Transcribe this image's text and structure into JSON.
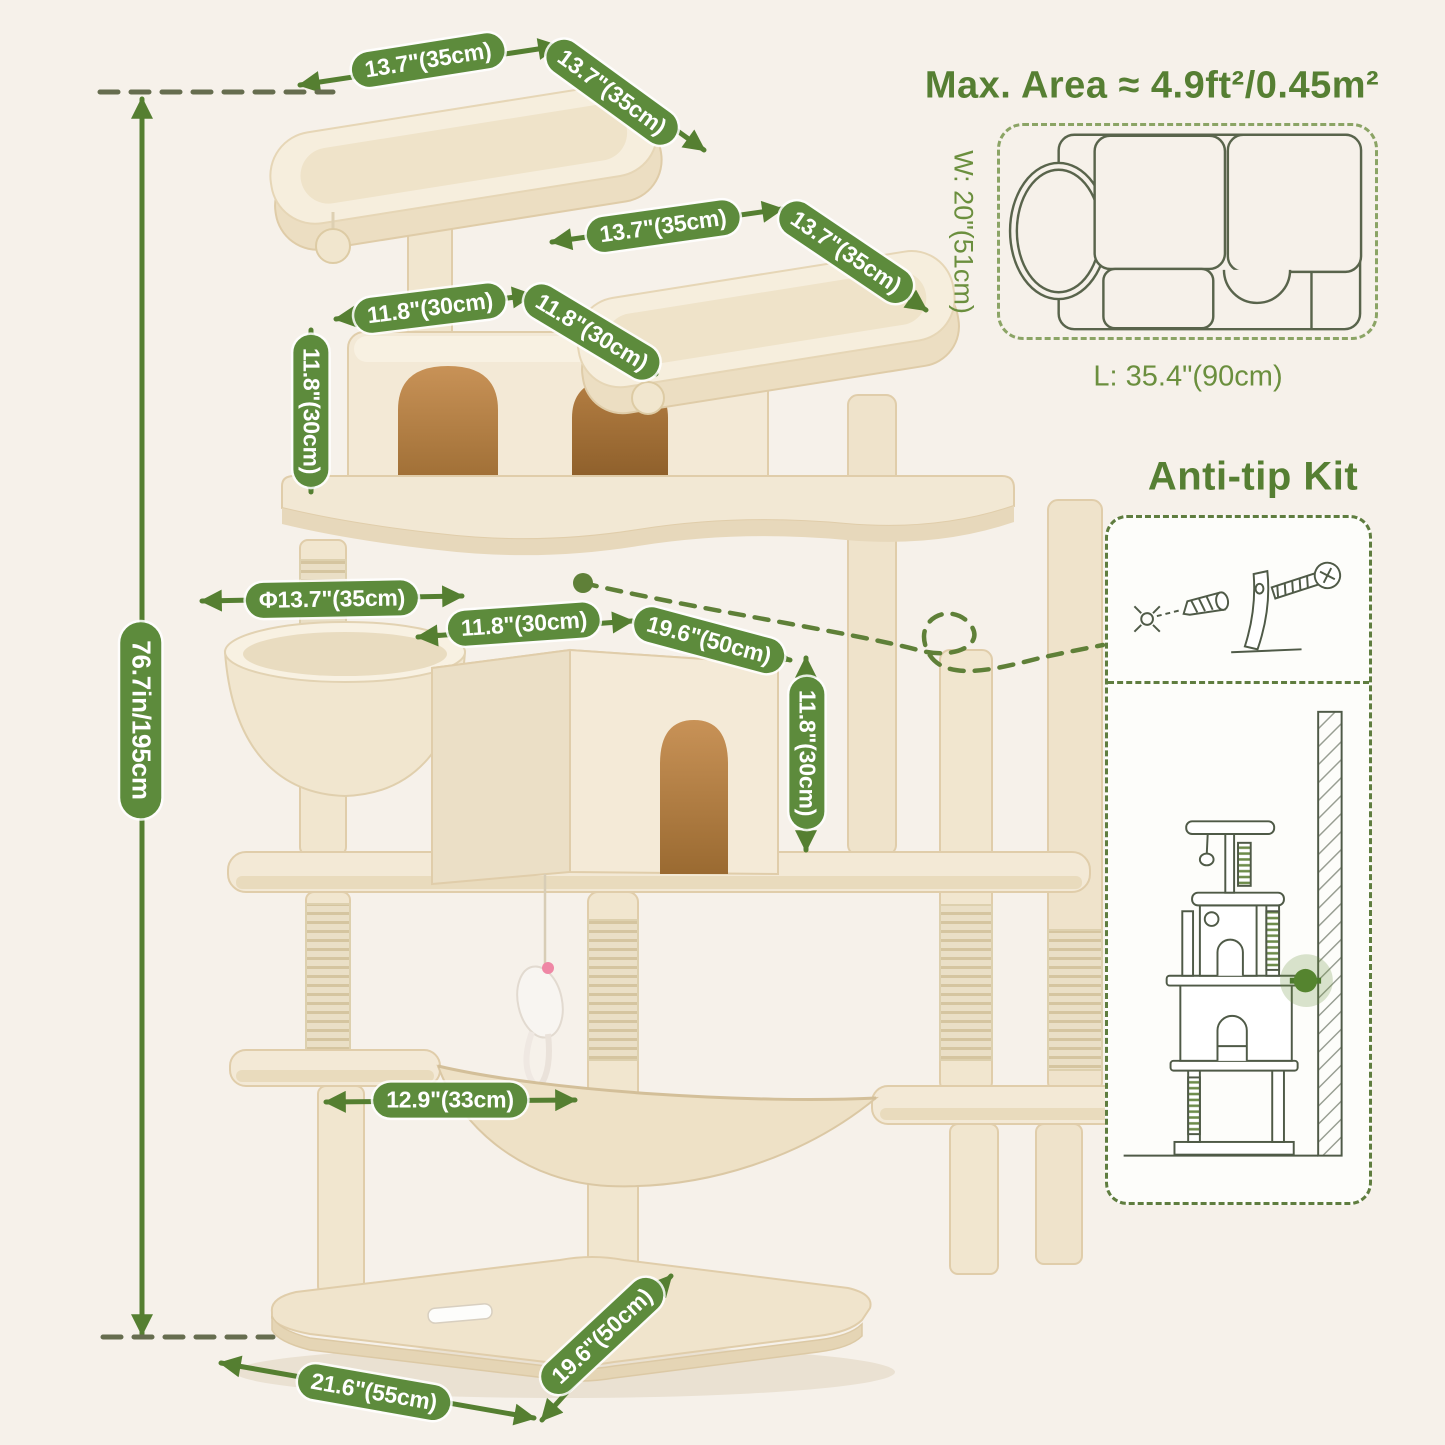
{
  "colors": {
    "background": "#f6f1ea",
    "accent_green": "#5d8b3c",
    "heading_green": "#567f33",
    "line_art": "#4f5a47"
  },
  "labels": {
    "top_platform_width": "13.7\"(35cm)",
    "top_platform_depth": "13.7\"(35cm)",
    "upper_platform_width": "13.7\"(35cm)",
    "upper_platform_depth": "13.7\"(35cm)",
    "condo_width": "11.8\"(30cm)",
    "condo_depth": "11.8\"(30cm)",
    "condo_height": "11.8\"(30cm)",
    "basket_diameter": "Φ13.7\"(35cm)",
    "cube_depth": "11.8\"(30cm)",
    "cube_width": "19.6\"(50cm)",
    "cube_height": "11.8\"(30cm)",
    "hammock_width": "12.9\"(33cm)",
    "base_width": "21.6\"(55cm)",
    "base_depth": "19.6\"(50cm)",
    "total_height": "76.7in/195cm"
  },
  "max_area": {
    "title": "Max. Area ≈ 4.9ft²/0.45m²",
    "width": "W: 20\"(51cm)",
    "length": "L: 35.4\"(90cm)"
  },
  "anti_tip": {
    "title": "Anti-tip Kit"
  }
}
